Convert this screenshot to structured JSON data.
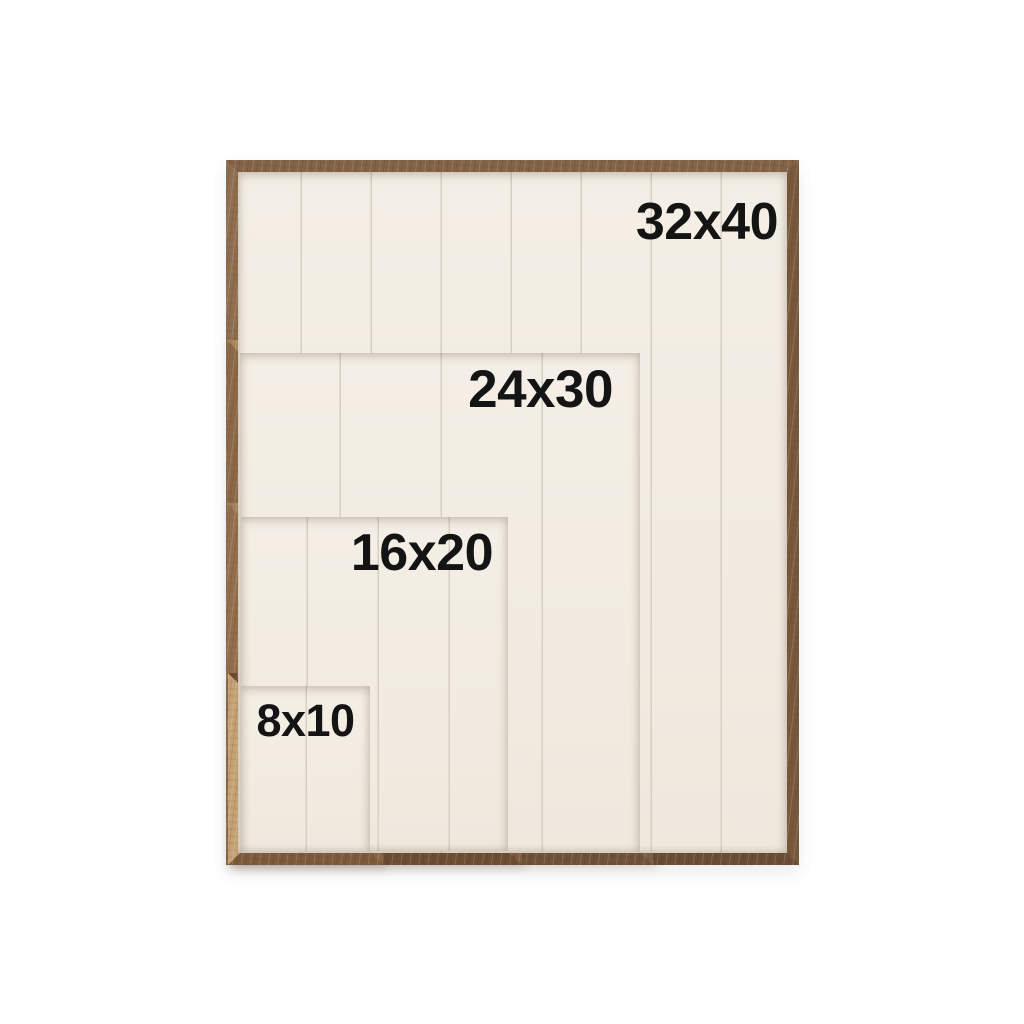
{
  "colors": {
    "background": "#ffffff",
    "label_text": "#141414",
    "panel_cream": "#f1ebe1",
    "plank_line": "#d5cfc4",
    "wood_light_tan": "#c5a377",
    "wood_medium_brown": "#8a6849",
    "wood_dark_brown": "#6b4b33"
  },
  "frames": [
    {
      "label": "32x40"
    },
    {
      "label": "24x30"
    },
    {
      "label": "16x20"
    },
    {
      "label": "8x10"
    }
  ]
}
